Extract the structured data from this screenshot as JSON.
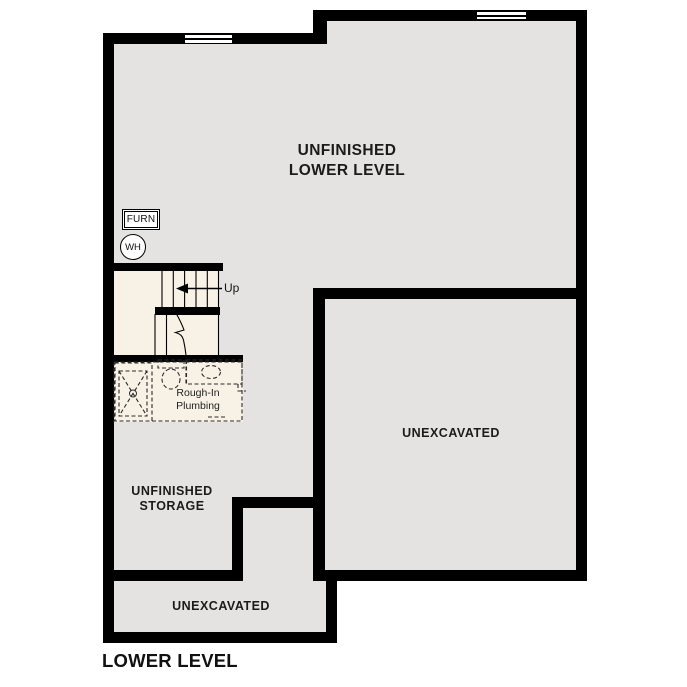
{
  "plan_title": "LOWER LEVEL",
  "rooms": {
    "unfinished_lower_level": "UNFINISHED\nLOWER LEVEL",
    "unexcavated_main": "UNEXCAVATED",
    "unfinished_storage": "UNFINISHED\nSTORAGE",
    "unexcavated_lower": "UNEXCAVATED"
  },
  "annotations": {
    "furnace": "FURN",
    "water_heater": "WH",
    "stair_direction": "Up",
    "rough_in_plumbing": "Rough-In\nPlumbing"
  },
  "colors": {
    "wall": "#000000",
    "floor": "#e4e3e1",
    "stair_floor": "#f8f2e6",
    "background": "#ffffff"
  }
}
